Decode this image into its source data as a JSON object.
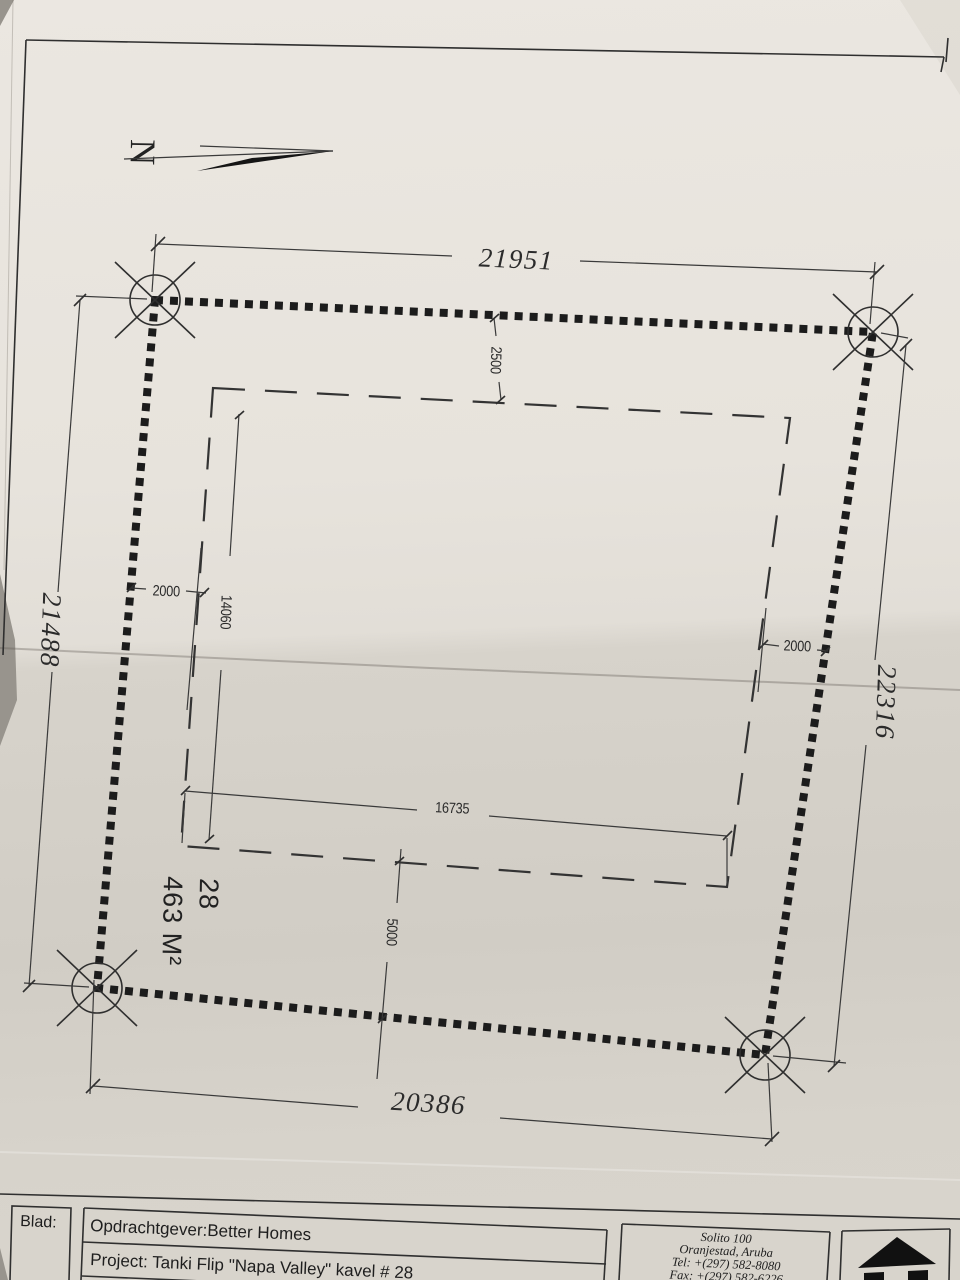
{
  "north": {
    "label": "N"
  },
  "plot": {
    "number": "28",
    "area": "463 M²"
  },
  "dimensions": {
    "top": "21951",
    "left": "21488",
    "right": "22316",
    "bottom": "20386",
    "setback_top": "2500",
    "setback_left_offset": "2000",
    "setback_left_height": "14060",
    "setback_right_offset": "2000",
    "setback_width": "16735",
    "setback_bottom": "5000"
  },
  "title_block": {
    "blad_label": "Blad:",
    "client": "Opdrachtgever:Better Homes",
    "project": "Project:  Tanki Flip \"Napa Valley\" kavel # 28",
    "company": {
      "name": "Solito 100",
      "city": "Oranjestad,  Aruba",
      "tel": "Tel:  +(297)  582-8080",
      "fax": "Fax:  +(297)  582-6226"
    }
  },
  "colors": {
    "paper_upper": "#eae6e0",
    "paper_lower": "#d2cec6",
    "ink": "#2b2b2b",
    "background": "#98948d"
  }
}
